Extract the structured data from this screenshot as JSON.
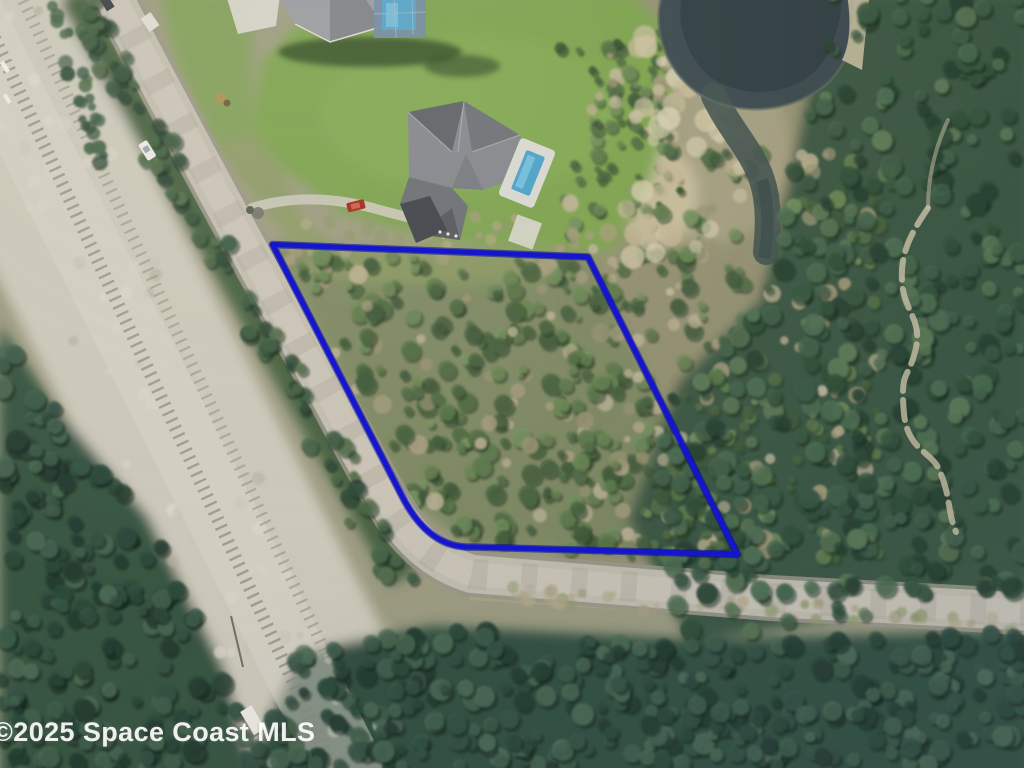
{
  "watermark": {
    "text": "©2025 Space Coast MLS"
  },
  "map": {
    "type": "aerial-photograph",
    "overlay": {
      "parcel_boundary": {
        "shape": "quadrilateral-with-rounded-southwest-corner",
        "color": "#1515d0",
        "underlay_color": "#000a96",
        "stroke_width": 5,
        "path": "M272.5,244.5 L588,257 L737.5,554.5 L472,547 Q429,549 402,496 Z",
        "vertices_px": [
          [
            272.5,
            244.5
          ],
          [
            588,
            257
          ],
          [
            737.5,
            554.5
          ],
          [
            472,
            547
          ],
          [
            402,
            496
          ]
        ]
      }
    },
    "feature_colors": {
      "street": "#c1bcae",
      "railroad_ballast": "#cbc7b9",
      "lawn": "#7ba14d",
      "pond_water": "#3a484d",
      "dense_forest": "#3a5942",
      "scrub": "#8f8c6d",
      "sand_trail": "#cdc3a6"
    }
  }
}
